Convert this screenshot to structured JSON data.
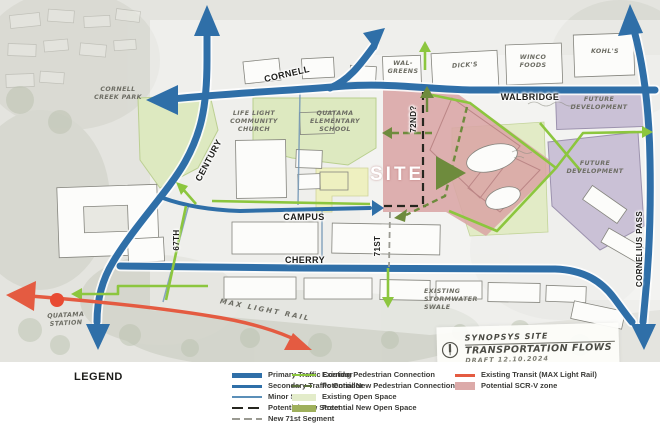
{
  "map": {
    "streets": {
      "cornell": "CORNELL",
      "walbridge": "WALBRIDGE",
      "campus": "CAMPUS",
      "cherry": "CHERRY",
      "century": "CENTURY",
      "st67": "67TH",
      "st71": "71ST",
      "st72": "72ND?",
      "cornelius_pass": "CORNELIUS PASS"
    },
    "site_label": "SITE",
    "places": {
      "cornell_creek_park": "CORNELL\nCREEK PARK",
      "life_light_church": "LIFE LIGHT\nCOMMUNITY\nCHURCH",
      "quatama_school": "QUATAMA\nELEMENTARY\nSCHOOL",
      "walgreens": "WAL-\nGREENS",
      "dicks": "DICK'S",
      "winco": "WINCO\nFOODS",
      "kohls": "KOHL'S",
      "future_dev_north": "FUTURE\nDEVELOPMENT",
      "future_dev_south": "FUTURE\nDEVELOPMENT",
      "stormwater_swale": "EXISTING\nSTORMWATER\nSWALE",
      "max_light_rail": "MAX LIGHT RAIL",
      "quatama_station": "QUATAMA\nSTATION"
    },
    "note": {
      "line1": "SYNOPSYS SITE",
      "line2": "TRANSPORTATION FLOWS",
      "line3": "DRAFT 12.10.2024"
    }
  },
  "legend": {
    "title": "LEGEND",
    "col1": [
      {
        "label": "Primary Traffic Corridor"
      },
      {
        "label": "Secondary Traffic Corridor"
      },
      {
        "label": "Minor Street"
      },
      {
        "label": "Potential New Street"
      },
      {
        "label": "New 71st Segment"
      }
    ],
    "col2": [
      {
        "label": "Existing Pedestrian Connection"
      },
      {
        "label": "Potential New Pedestrian Connection"
      },
      {
        "label": "Existing Open Space"
      },
      {
        "label": "Potential New Open Space"
      }
    ],
    "col3": [
      {
        "label": "Existing Transit (MAX Light Rail)"
      },
      {
        "label": "Potential SCR-V zone"
      }
    ]
  },
  "colors": {
    "primary_corridor": "#2f6fa8",
    "pedestrian_green": "#8cc63e",
    "new_pedestrian_olive": "#6e8b3d",
    "open_space_green": "#dfe9c3",
    "new_open_space_olive": "#9fb05c",
    "transit_red": "#e45b41",
    "scrv_pink": "#dcaaa9",
    "future_dev_purple": "#cac1d6"
  }
}
